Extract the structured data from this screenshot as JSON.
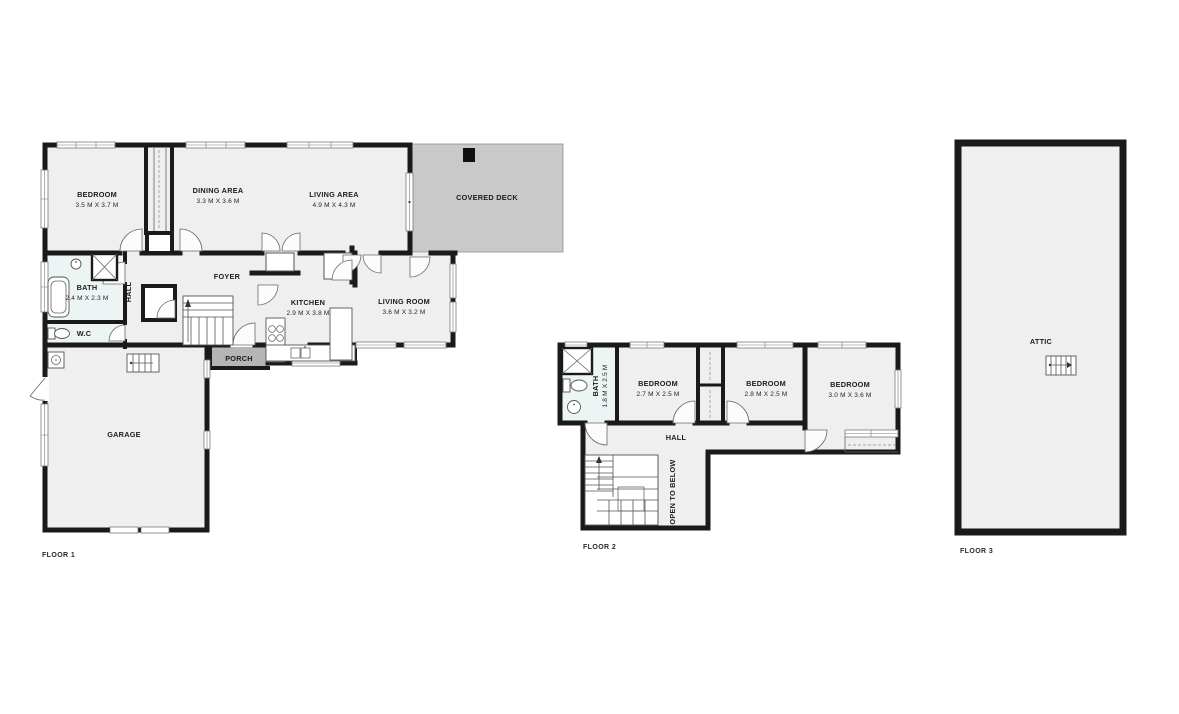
{
  "document_type": "floor_plan",
  "colors": {
    "wall": "#1a1a1a",
    "room_fill": "#efefef",
    "bath_fill": "#ecf4f4",
    "deck_fill": "#c9c9c9",
    "porch_fill": "#b5b5b5",
    "text": "#1c1c1c",
    "background": "#ffffff"
  },
  "floors": [
    {
      "label": "FLOOR 1",
      "rooms": {
        "bedroom": {
          "name": "BEDROOM",
          "dims": "3.5 M X 3.7 M"
        },
        "dining_area": {
          "name": "DINING AREA",
          "dims": "3.3 M X 3.6 M"
        },
        "living_area": {
          "name": "LIVING AREA",
          "dims": "4.9 M X 4.3 M"
        },
        "covered_deck": {
          "name": "COVERED DECK"
        },
        "bath": {
          "name": "BATH",
          "dims": "2.4 M X 2.3 M"
        },
        "hall": {
          "name": "HALL"
        },
        "foyer": {
          "name": "FOYER"
        },
        "kitchen": {
          "name": "KITCHEN",
          "dims": "2.9 M X 3.8 M"
        },
        "living_room": {
          "name": "LIVING ROOM",
          "dims": "3.6 M X 3.2 M"
        },
        "wc": {
          "name": "W.C"
        },
        "porch": {
          "name": "PORCH"
        },
        "garage": {
          "name": "GARAGE"
        }
      }
    },
    {
      "label": "FLOOR 2",
      "rooms": {
        "bath": {
          "name": "BATH",
          "dims": "1.8 M X 2.5 M"
        },
        "bedroom_1": {
          "name": "BEDROOM",
          "dims": "2.7 M X 2.5 M"
        },
        "bedroom_2": {
          "name": "BEDROOM",
          "dims": "2.8 M X 2.5 M"
        },
        "bedroom_3": {
          "name": "BEDROOM",
          "dims": "3.0 M X 3.6 M"
        },
        "hall": {
          "name": "HALL"
        },
        "open_to_below": {
          "name": "OPEN TO BELOW"
        }
      }
    },
    {
      "label": "FLOOR 3",
      "rooms": {
        "attic": {
          "name": "ATTIC"
        }
      }
    }
  ]
}
